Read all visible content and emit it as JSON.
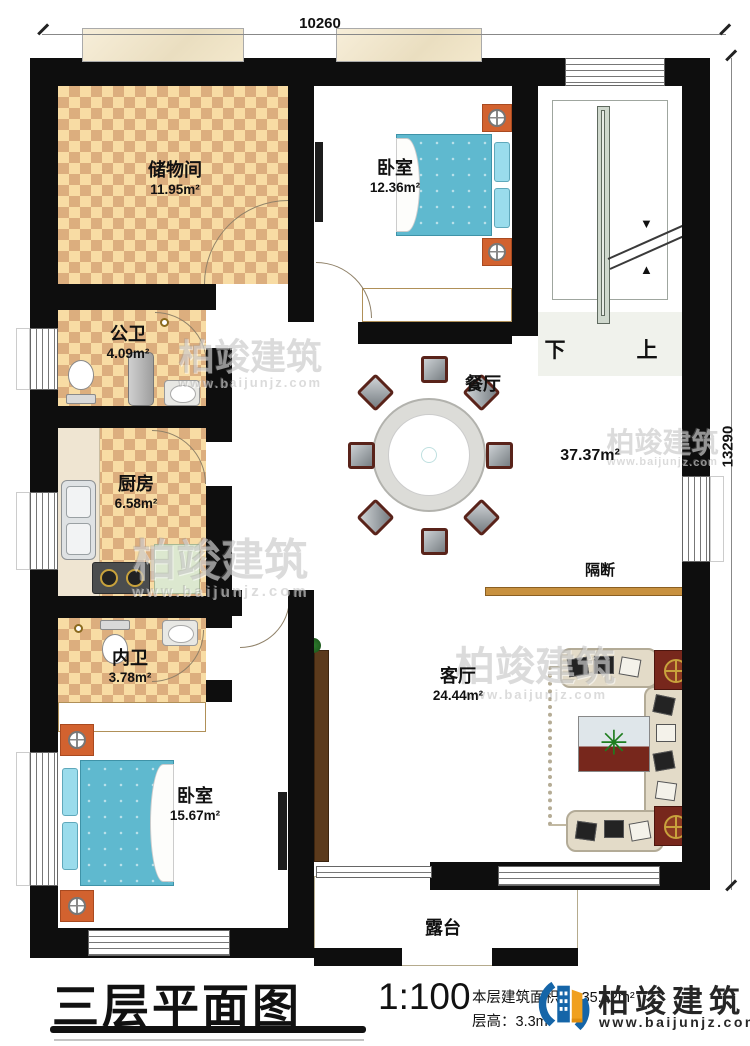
{
  "dimensions": {
    "width": "10260",
    "height": "13290"
  },
  "rooms": {
    "storage": {
      "name": "储物间",
      "area": "11.95m²"
    },
    "bedroom_top": {
      "name": "卧室",
      "area": "12.36m²"
    },
    "public_bath": {
      "name": "公卫",
      "area": "4.09m²"
    },
    "kitchen": {
      "name": "厨房",
      "area": "6.58m²"
    },
    "inner_bath": {
      "name": "内卫",
      "area": "3.78m²"
    },
    "bedroom_bottom": {
      "name": "卧室",
      "area": "15.67m²"
    },
    "dining": {
      "name": "餐厅"
    },
    "living": {
      "name": "客厅",
      "area": "24.44m²"
    },
    "terrace": {
      "name": "露台"
    }
  },
  "hall": {
    "area": "37.37m²",
    "partition_label": "隔断"
  },
  "stairs": {
    "down_label": "下",
    "up_label": "上"
  },
  "title_block": {
    "title": "三层平面图",
    "scale": "1:100",
    "area_label": "本层建筑面积：",
    "area_value": "135.52m²",
    "height_label": "层高：",
    "height_value": "3.3m"
  },
  "brand": {
    "name": "柏竣建筑",
    "website": "www.baijunjz.com"
  },
  "watermark": {
    "text": "柏竣建筑",
    "url": "www.baijunjz.com"
  }
}
